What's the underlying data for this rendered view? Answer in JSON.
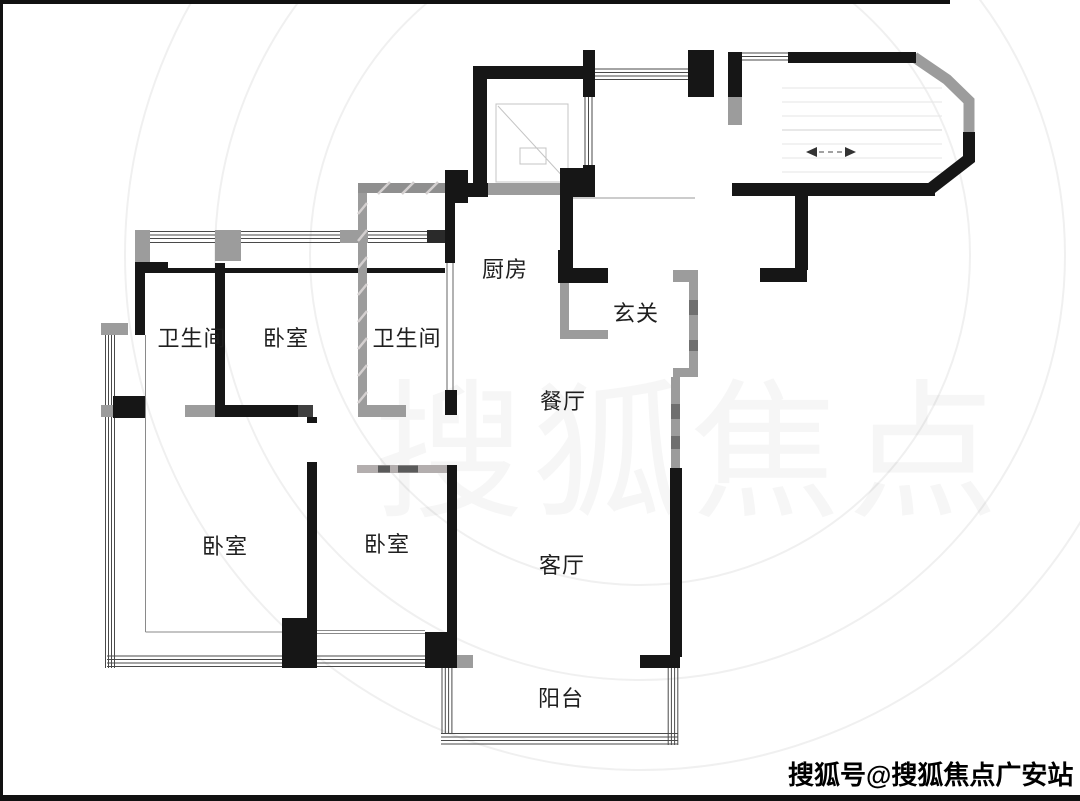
{
  "palette": {
    "wall_black": "#161616",
    "wall_gray": "#9c9c9c",
    "wall_gray_dark": "#6f6f6f",
    "window_line": "#4a4a4a",
    "label_color": "#1f1f1f"
  },
  "rooms": [
    {
      "id": "kitchen",
      "label": "厨房"
    },
    {
      "id": "entry",
      "label": "玄关"
    },
    {
      "id": "bathroom-left",
      "label": "卫生间"
    },
    {
      "id": "bedroom-top",
      "label": "卧室"
    },
    {
      "id": "bathroom-right",
      "label": "卫生间"
    },
    {
      "id": "dining",
      "label": "餐厅"
    },
    {
      "id": "bedroom-bottom-left",
      "label": "卧室"
    },
    {
      "id": "bedroom-bottom-middle",
      "label": "卧室"
    },
    {
      "id": "living",
      "label": "客厅"
    },
    {
      "id": "balcony",
      "label": "阳台"
    }
  ],
  "watermark": {
    "text": "搜狐号@搜狐焦点广安站"
  },
  "ghost_watermark": {
    "text": "搜狐焦点"
  }
}
